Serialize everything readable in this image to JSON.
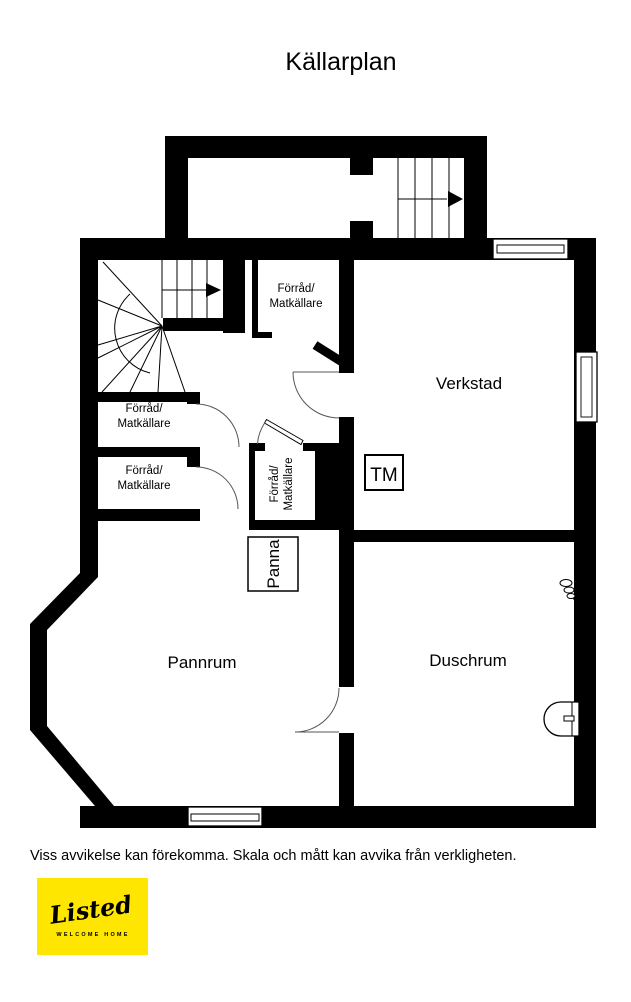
{
  "title": "Källarplan",
  "plan": {
    "rooms": {
      "storage_top": {
        "line1": "Förråd/",
        "line2": "Matkällare"
      },
      "storage_left_a": {
        "line1": "Förråd/",
        "line2": "Matkällare"
      },
      "storage_left_b": {
        "line1": "Förråd/",
        "line2": "Matkällare"
      },
      "storage_center": {
        "line1": "Förråd/",
        "line2": "Matkällare"
      },
      "workshop": {
        "label": "Verkstad"
      },
      "boiler_room": {
        "label": "Pannrum"
      },
      "shower_room": {
        "label": "Duschrum"
      }
    },
    "fixtures": {
      "washing_machine_label": "TM",
      "boiler_label": "Panna"
    },
    "colors": {
      "wall": "#000000",
      "background": "#ffffff"
    }
  },
  "footer": {
    "disclaimer": "Viss avvikelse kan förekomma. Skala och mått kan avvika från verkligheten."
  },
  "logo": {
    "brand": "Listed",
    "tagline": "WELCOME HOME",
    "background": "#FFE600"
  }
}
